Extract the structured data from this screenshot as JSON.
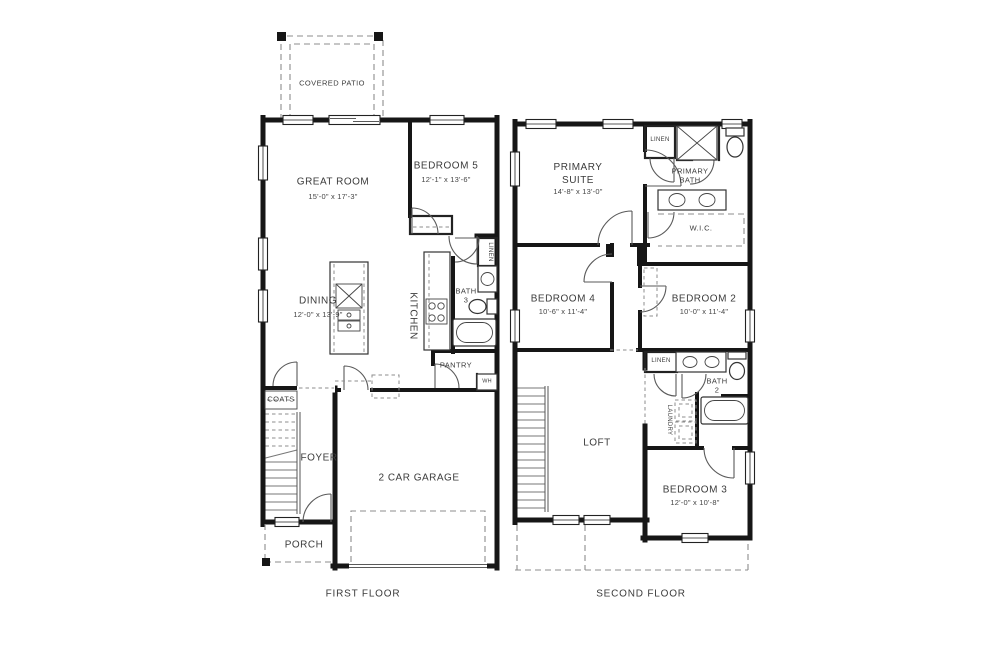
{
  "page": {
    "background": "#ffffff",
    "wall_color": "#161616",
    "text_color": "#3b3b3b"
  },
  "first_floor": {
    "caption": "FIRST FLOOR",
    "rooms": {
      "covered_patio": {
        "name": "COVERED PATIO"
      },
      "great_room": {
        "name": "GREAT ROOM",
        "dims": "15'-0\" x 17'-3\""
      },
      "bedroom_5": {
        "name": "BEDROOM 5",
        "dims": "12'-1\" x 13'-6\""
      },
      "dining": {
        "name": "DINING",
        "dims": "12'-0\" x 13'-9\""
      },
      "kitchen": {
        "name": "KITCHEN"
      },
      "bath_3": {
        "name": "BATH\n3"
      },
      "linen": {
        "name": "LINEN"
      },
      "pantry": {
        "name": "PANTRY"
      },
      "water_heater": {
        "name": "WH"
      },
      "coats": {
        "name": "COATS"
      },
      "foyer": {
        "name": "FOYER"
      },
      "garage": {
        "name": "2 CAR GARAGE"
      },
      "porch": {
        "name": "PORCH"
      }
    }
  },
  "second_floor": {
    "caption": "SECOND FLOOR",
    "rooms": {
      "primary_suite": {
        "name": "PRIMARY\nSUITE",
        "dims": "14'-8\" x 13'-0\""
      },
      "primary_bath": {
        "name": "PRIMARY\nBATH"
      },
      "linen_upper": {
        "name": "LINEN"
      },
      "wic": {
        "name": "W.I.C."
      },
      "bedroom_4": {
        "name": "BEDROOM 4",
        "dims": "10'-6\" x 11'-4\""
      },
      "bedroom_2": {
        "name": "BEDROOM 2",
        "dims": "10'-0\" x 11'-4\""
      },
      "linen_hall": {
        "name": "LINEN"
      },
      "bath_2": {
        "name": "BATH\n2"
      },
      "laundry": {
        "name": "LAUNDRY"
      },
      "loft": {
        "name": "LOFT"
      },
      "bedroom_3": {
        "name": "BEDROOM 3",
        "dims": "12'-0\" x 10'-8\""
      }
    }
  }
}
